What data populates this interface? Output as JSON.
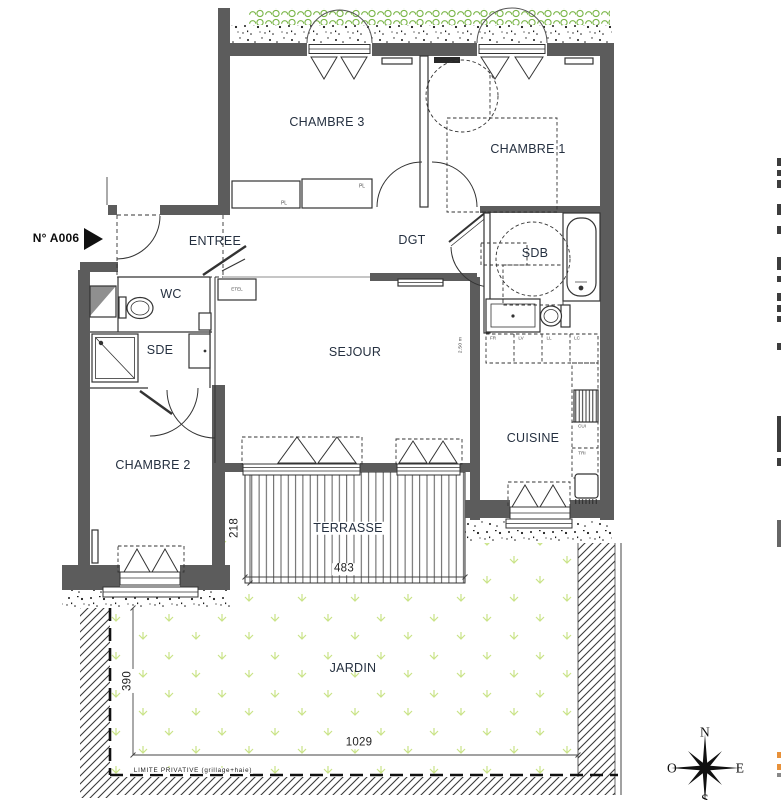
{
  "plan": {
    "unit": {
      "label": "N° A006"
    },
    "rooms": {
      "chambre3": "CHAMBRE 3",
      "chambre1": "CHAMBRE 1",
      "entree": "ENTREE",
      "dgt": "DGT",
      "wc": "WC",
      "sde": "SDE",
      "sdb": "SDB",
      "sejour": "SEJOUR",
      "chambre2": "CHAMBRE 2",
      "cuisine": "CUISINE",
      "terrasse": "TERRASSE",
      "jardin": "JARDIN"
    },
    "storage": {
      "pl_left": "PL",
      "pl_right": "PL",
      "etel": "ETEL"
    },
    "appliances": {
      "fr": "FR",
      "lv": "LV",
      "ll": "LL",
      "lc": "LC",
      "cui": "CUI",
      "tri": "TRI"
    },
    "dimensions": {
      "terrasse_depth": "218",
      "terrasse_width": "483",
      "jardin_depth": "390",
      "jardin_width": "1029",
      "ceiling_height": "2.50 m"
    },
    "boundary": {
      "limite": "LIMITE PRIVATIVE (grillage+haie)"
    },
    "compass": {
      "north": "N",
      "south": "S",
      "east": "E",
      "west": "O"
    },
    "colors": {
      "wall": "#5c5c5c",
      "hedge": "#7ab648",
      "grass": "#c9e387",
      "label": "#253040",
      "edge_accent": "#e8913a"
    }
  }
}
